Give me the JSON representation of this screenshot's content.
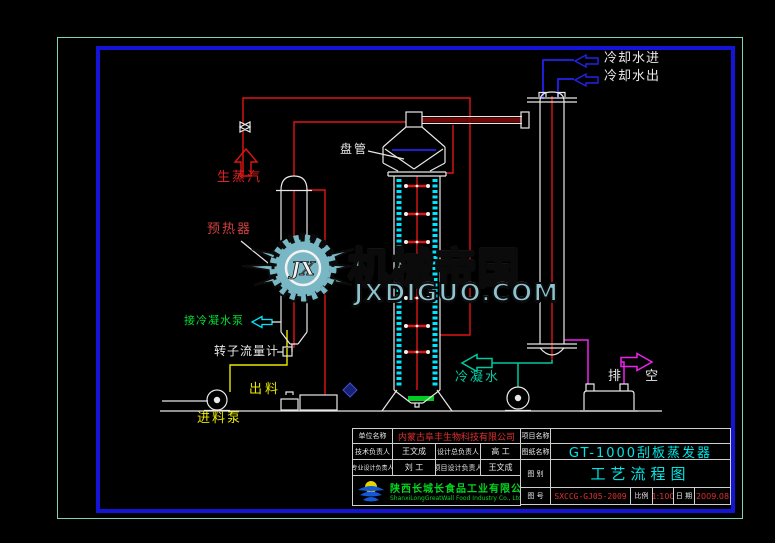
{
  "watermark": {
    "brand": "机械帝国",
    "site": "JXDIGUO.COM",
    "logo_text": "JX"
  },
  "diagram_labels": {
    "raw_steam": "生蒸汽",
    "preheater": "预热器",
    "coil": "盘管",
    "cooling_water_in": "冷却水进",
    "cooling_water_out": "冷却水出",
    "to_condensate_pump": "接冷凝水泵",
    "rotameter": "转子流量计",
    "discharge": "出料",
    "feed_pump": "进料泵",
    "condensate": "冷凝水",
    "vent": "排 空"
  },
  "title_block": {
    "unit_name_label": "单位名称",
    "unit_name": "内蒙古阜丰生物科技有限公司",
    "tech_lead_label": "技术负责人",
    "tech_lead": "王文成",
    "chief_designer_label": "设计总负责人",
    "chief_designer": "高 工",
    "discipline_lead_label": "专业设计负责人",
    "discipline_lead": "刘 工",
    "project_designer_label": "项目设计负责人",
    "project_designer": "王文成",
    "maker_cn": "陕西长城长食品工业有限公司",
    "maker_en": "ShanxiLongGreatWall Food Industry Co., Ltd.",
    "project_name_label": "项目名称",
    "project_name": "",
    "drawing_name_label": "图纸名称",
    "drawing_name": "GT-1000刮板蒸发器",
    "category_label": "图 别",
    "category": "工艺流程图",
    "number_label": "图 号",
    "number": "SXCCG-GJ05-2009",
    "scale_label": "比例",
    "scale": "1:100",
    "date_label": "日 期",
    "date": "2009.08"
  },
  "colors": {
    "frame_outer": "#7bd4b2",
    "frame_inner": "#1414d6",
    "pipe_red": "#e01414",
    "pipe_yellow": "#e8e800",
    "pipe_blue": "#2222ee",
    "pipe_cyan": "#00e5ff",
    "pipe_teal": "#00c9a0",
    "pipe_magenta": "#ee22ee",
    "equipment_white": "#e8e8e8",
    "text_cyan": "#00e5e5",
    "text_red": "#e03030",
    "text_green": "#00d820",
    "watermark_teal": "#8fc3cf"
  }
}
